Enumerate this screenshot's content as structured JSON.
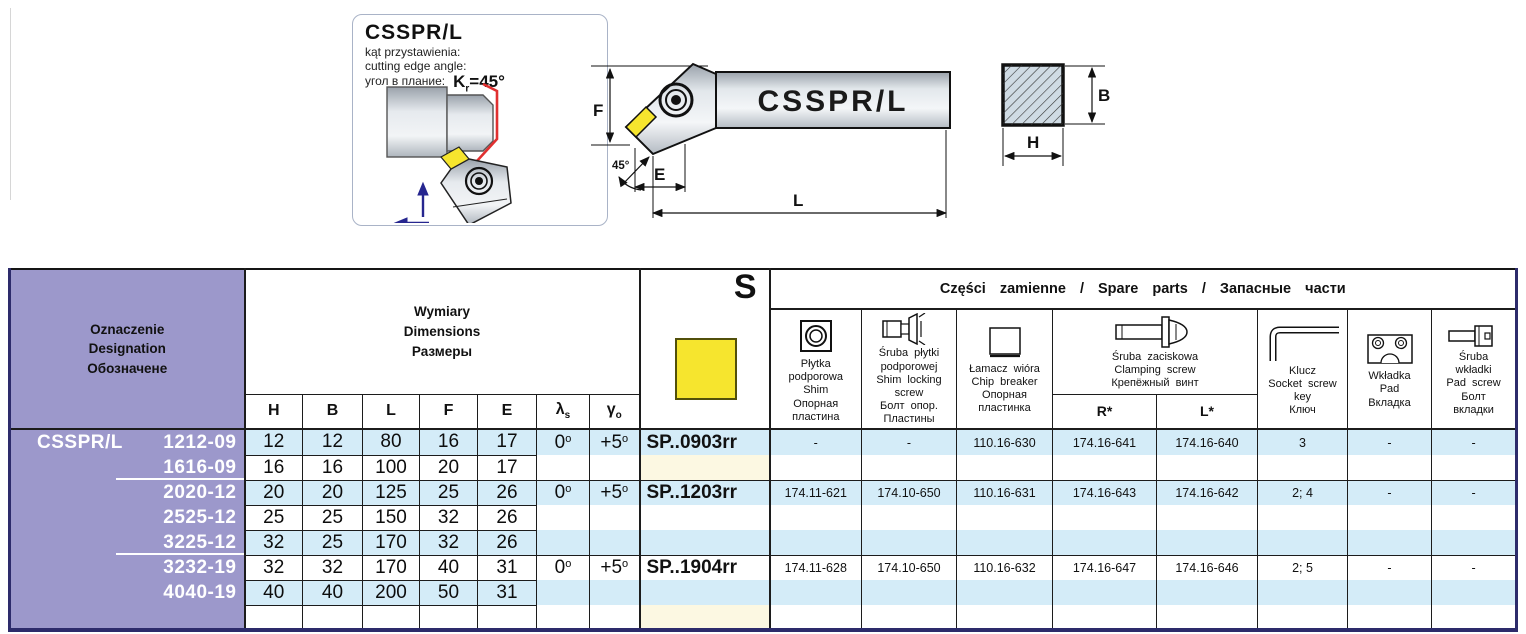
{
  "info_box": {
    "title": "CSSPR/L",
    "line_pl": "kąt przystawienia:",
    "line_en": "cutting edge angle:",
    "line_ru": "угол в плание:",
    "kr_k": "K",
    "kr_sub": "r",
    "kr_val": "=45°"
  },
  "drawings": {
    "shank_label": "CSSPR/L",
    "label_f": "F",
    "label_e": "E",
    "label_l": "L",
    "label_angle": "45°",
    "label_b": "B",
    "label_h": "H"
  },
  "table": {
    "header": {
      "designation_lines": [
        "Oznaczenie",
        "Designation",
        "Обозначене"
      ],
      "dimensions_lines": [
        "Wymiary",
        "Dimensions",
        "Размеры"
      ],
      "col_h": "H",
      "col_b": "B",
      "col_l": "L",
      "col_f": "F",
      "col_e": "E",
      "col_lambda": "λ",
      "col_lambda_sub": "s",
      "col_gamma": "γ",
      "col_gamma_sub": "o",
      "insert_shape": "S",
      "spare_title": "Części zamienne / Spare parts / Запасные части",
      "shim_lines": [
        "Płytka",
        "podporowa",
        "Shim",
        "Опорная",
        "пластина"
      ],
      "shim_screw_lines": [
        "Śruba płytki",
        "podporowej",
        "Shim locking",
        "screw",
        "Болт опор.",
        "Пластины"
      ],
      "chip_breaker_lines": [
        "Łamacz wióra",
        "Chip breaker",
        "Опорная",
        "пластинка"
      ],
      "clamp_screw_lines": [
        "Śruba zaciskowa",
        "Clamping screw",
        "Крепёжный винт"
      ],
      "clamp_r": "R*",
      "clamp_l": "L*",
      "key_lines": [
        "Klucz",
        "Socket screw",
        "key",
        "Ключ"
      ],
      "pad_lines": [
        "Wkładka",
        "Pad",
        "Вкладка"
      ],
      "pad_screw_lines": [
        "Śruba",
        "wkładki",
        "Pad screw",
        "Болт",
        "вкладки"
      ]
    },
    "brand": "CSSPR/L",
    "deg": "o",
    "rows": [
      {
        "size": "1212-09",
        "h": "12",
        "b": "12",
        "l": "80",
        "f": "16",
        "e": "17",
        "lam": "0",
        "gam": "+5"
      },
      {
        "size": "1616-09",
        "h": "16",
        "b": "16",
        "l": "100",
        "f": "20",
        "e": "17"
      },
      {
        "size": "2020-12",
        "h": "20",
        "b": "20",
        "l": "125",
        "f": "25",
        "e": "26",
        "lam": "0",
        "gam": "+5"
      },
      {
        "size": "2525-12",
        "h": "25",
        "b": "25",
        "l": "150",
        "f": "32",
        "e": "26"
      },
      {
        "size": "3225-12",
        "h": "32",
        "b": "25",
        "l": "170",
        "f": "32",
        "e": "26"
      },
      {
        "size": "3232-19",
        "h": "32",
        "b": "32",
        "l": "170",
        "f": "40",
        "e": "31",
        "lam": "0",
        "gam": "+5"
      },
      {
        "size": "4040-19",
        "h": "40",
        "b": "40",
        "l": "200",
        "f": "50",
        "e": "31"
      },
      {
        "size": ""
      }
    ],
    "groups": [
      {
        "insert": "SP..0903rr",
        "shim": "-",
        "shim_screw": "-",
        "chip": "110.16-630",
        "screw_r": "174.16-641",
        "screw_l": "174.16-640",
        "key": "3",
        "pad": "-",
        "pad_screw": "-"
      },
      {
        "insert": "SP..1203rr",
        "shim": "174.11-621",
        "shim_screw": "174.10-650",
        "chip": "110.16-631",
        "screw_r": "174.16-643",
        "screw_l": "174.16-642",
        "key": "2; 4",
        "pad": "-",
        "pad_screw": "-"
      },
      {
        "insert": "SP..1904rr",
        "shim": "174.11-628",
        "shim_screw": "174.10-650",
        "chip": "110.16-632",
        "screw_r": "174.16-647",
        "screw_l": "174.16-646",
        "key": "2; 5",
        "pad": "-",
        "pad_screw": "-"
      }
    ]
  }
}
